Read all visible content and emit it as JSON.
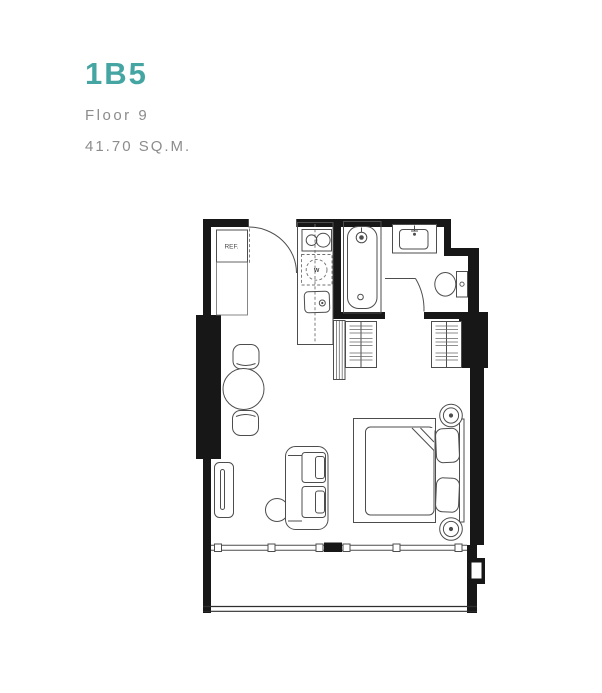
{
  "unit": {
    "code": "1B5",
    "floor_label": "Floor 9",
    "area_label": "41.70 SQ.M."
  },
  "colors": {
    "accent_teal": "#44a5a2",
    "subtitle_gray": "#8c8c8c",
    "wall_black": "#171717",
    "furniture_line_gray": "#4d4d4d",
    "background": "#ffffff"
  },
  "floor_plan": {
    "labels": {
      "refrigerator": "REF.",
      "washer": "W"
    },
    "fixtures": [
      "entrance-door",
      "refrigerator",
      "entry-counter",
      "kitchen-counter",
      "stove-2-burner",
      "washing-machine",
      "kitchen-sink",
      "bathtub",
      "vanity-sink",
      "toilet",
      "bathroom-door",
      "louver-panel",
      "wardrobe-left",
      "wardrobe-right",
      "dining-stool-top",
      "dining-table",
      "dining-stool-bottom",
      "tv-console",
      "side-table",
      "sofa",
      "bed-platform",
      "mattress",
      "blanket-fold",
      "pillow-top",
      "pillow-bottom",
      "headboard",
      "bedside-lamp-top",
      "bedside-lamp-bottom",
      "balcony-sliding-door",
      "balcony-railing",
      "service-niche"
    ]
  }
}
